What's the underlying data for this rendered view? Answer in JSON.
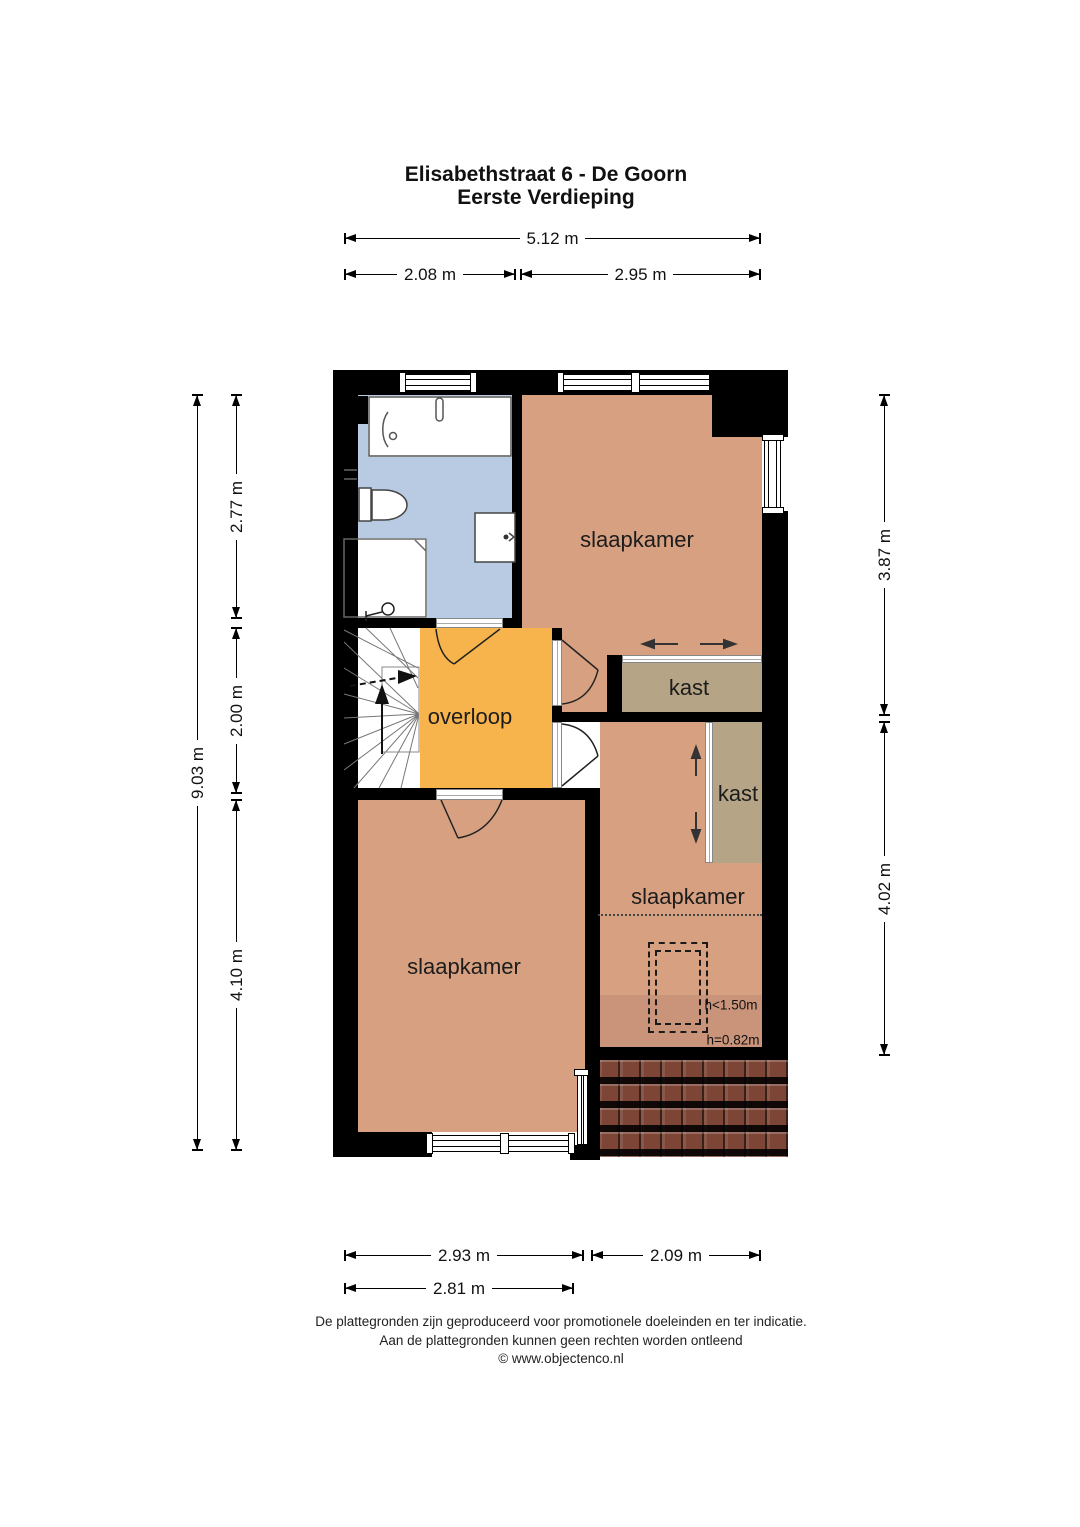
{
  "title": {
    "line1": "Elisabethstraat 6 - De Goorn",
    "line2": "Eerste Verdieping"
  },
  "dims": {
    "top_total": "5.12 m",
    "top_left": "2.08 m",
    "top_right": "2.95 m",
    "left_total": "9.03 m",
    "left_seg1": "2.77 m",
    "left_seg2": "2.00 m",
    "left_seg3": "4.10 m",
    "right_seg1": "3.87 m",
    "right_seg2": "4.02 m",
    "bottom_left": "2.93 m",
    "bottom_right": "2.09 m",
    "bottom_left_inner": "2.81 m"
  },
  "rooms": {
    "bedroom_top": "slaapkamer",
    "closet_top": "kast",
    "closet_right": "kast",
    "bedroom_right": "slaapkamer",
    "bedroom_left": "slaapkamer",
    "landing": "overloop"
  },
  "annotations": {
    "low_headroom": "h<1.50m",
    "knee_wall": "h=0.82m"
  },
  "footer": {
    "line1": "De plattegronden zijn geproduceerd voor promotionele doeleinden en ter indicatie.",
    "line2": "Aan de plattegronden kunnen geen rechten worden ontleend",
    "line3": "© www.objectenco.nl"
  },
  "colors": {
    "wall": "#000000",
    "bedroom": "#d7a081",
    "bedroom_shaded": "#c9947a",
    "closet": "#b5a486",
    "landing": "#f7b34c",
    "bathroom": "#b8cbe3",
    "roof_base": "#7c4536"
  }
}
